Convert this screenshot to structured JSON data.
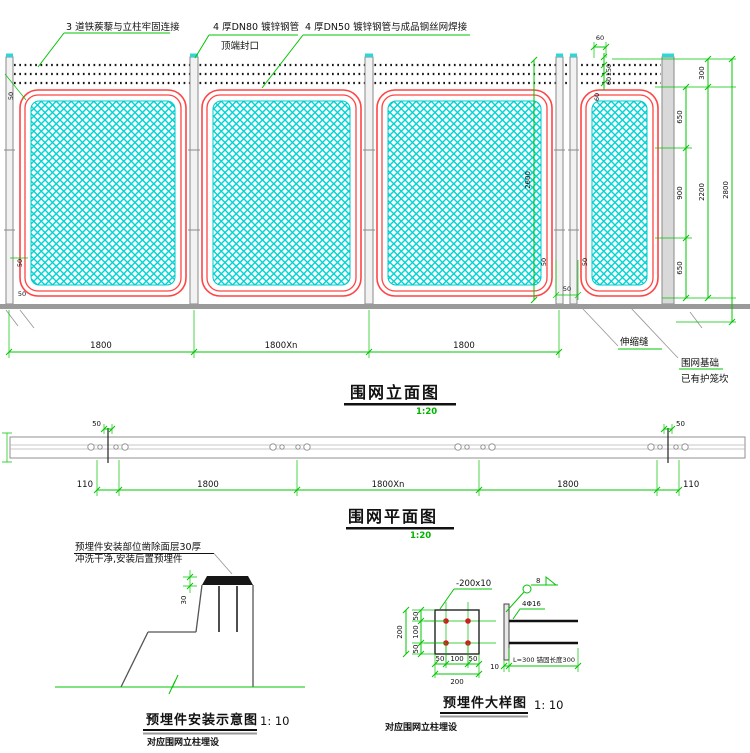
{
  "colors": {
    "dimension": "#00c400",
    "mesh": "#00d4d4",
    "frame": "#ff4444",
    "structure": "#8a8a8a",
    "anchor_dot": "#cc2020"
  },
  "elevation": {
    "title": "围网立面图",
    "scale": "1:20",
    "notes": {
      "barbed_wire": "3 道铁蒺藜与立柱牢固连接",
      "dn80": "4 厚DN80  镀锌钢管",
      "dn80_cap": "顶端封口",
      "dn50": "4 厚DN50  镀锌钢管与成品钢丝网焊接",
      "expansion_joint": "伸缩缝",
      "foundation_1": "围网基础",
      "foundation_2": "已有护笼坎"
    },
    "dims": {
      "bottom": [
        "1800",
        "1800Xn",
        "1800"
      ],
      "right_inner": [
        "650",
        "900",
        "650"
      ],
      "right_top": "300",
      "right_mid_total": "2200",
      "right_total": "2800",
      "post_height": "2600",
      "top_width": "60",
      "wire_spacing": [
        "150",
        "60"
      ],
      "corner_offset": "60",
      "mesh_offsets": [
        "50",
        "50",
        "50",
        "50",
        "50",
        "50"
      ]
    }
  },
  "plan": {
    "title": "围网平面图",
    "scale": "1:20",
    "dims": {
      "post_width_left": "50",
      "post_width_right": "50",
      "bottom": [
        "110",
        "1800",
        "1800Xn",
        "1800",
        "110"
      ]
    }
  },
  "install": {
    "title": "预埋件安装示意图",
    "scale": "1: 10",
    "subtitle": "对应围网立柱埋设",
    "note_1": "预埋件安装部位凿除面层30厚",
    "note_2": "冲洗干净,安装后置预埋件",
    "chisel_depth": "30"
  },
  "embed": {
    "title": "预埋件大样图",
    "scale": "1: 10",
    "subtitle": "对应围网立柱埋设",
    "plate_label": "-200x10",
    "weld_size": "8",
    "anchor_label": "4Φ16",
    "plate_thickness": "10",
    "anchor_note": "L=300 锚固长度300",
    "dims_v": [
      "50",
      "100",
      "50"
    ],
    "dims_v_total": "200",
    "dims_h": [
      "50",
      "100",
      "50"
    ],
    "dims_h_total": "200"
  }
}
